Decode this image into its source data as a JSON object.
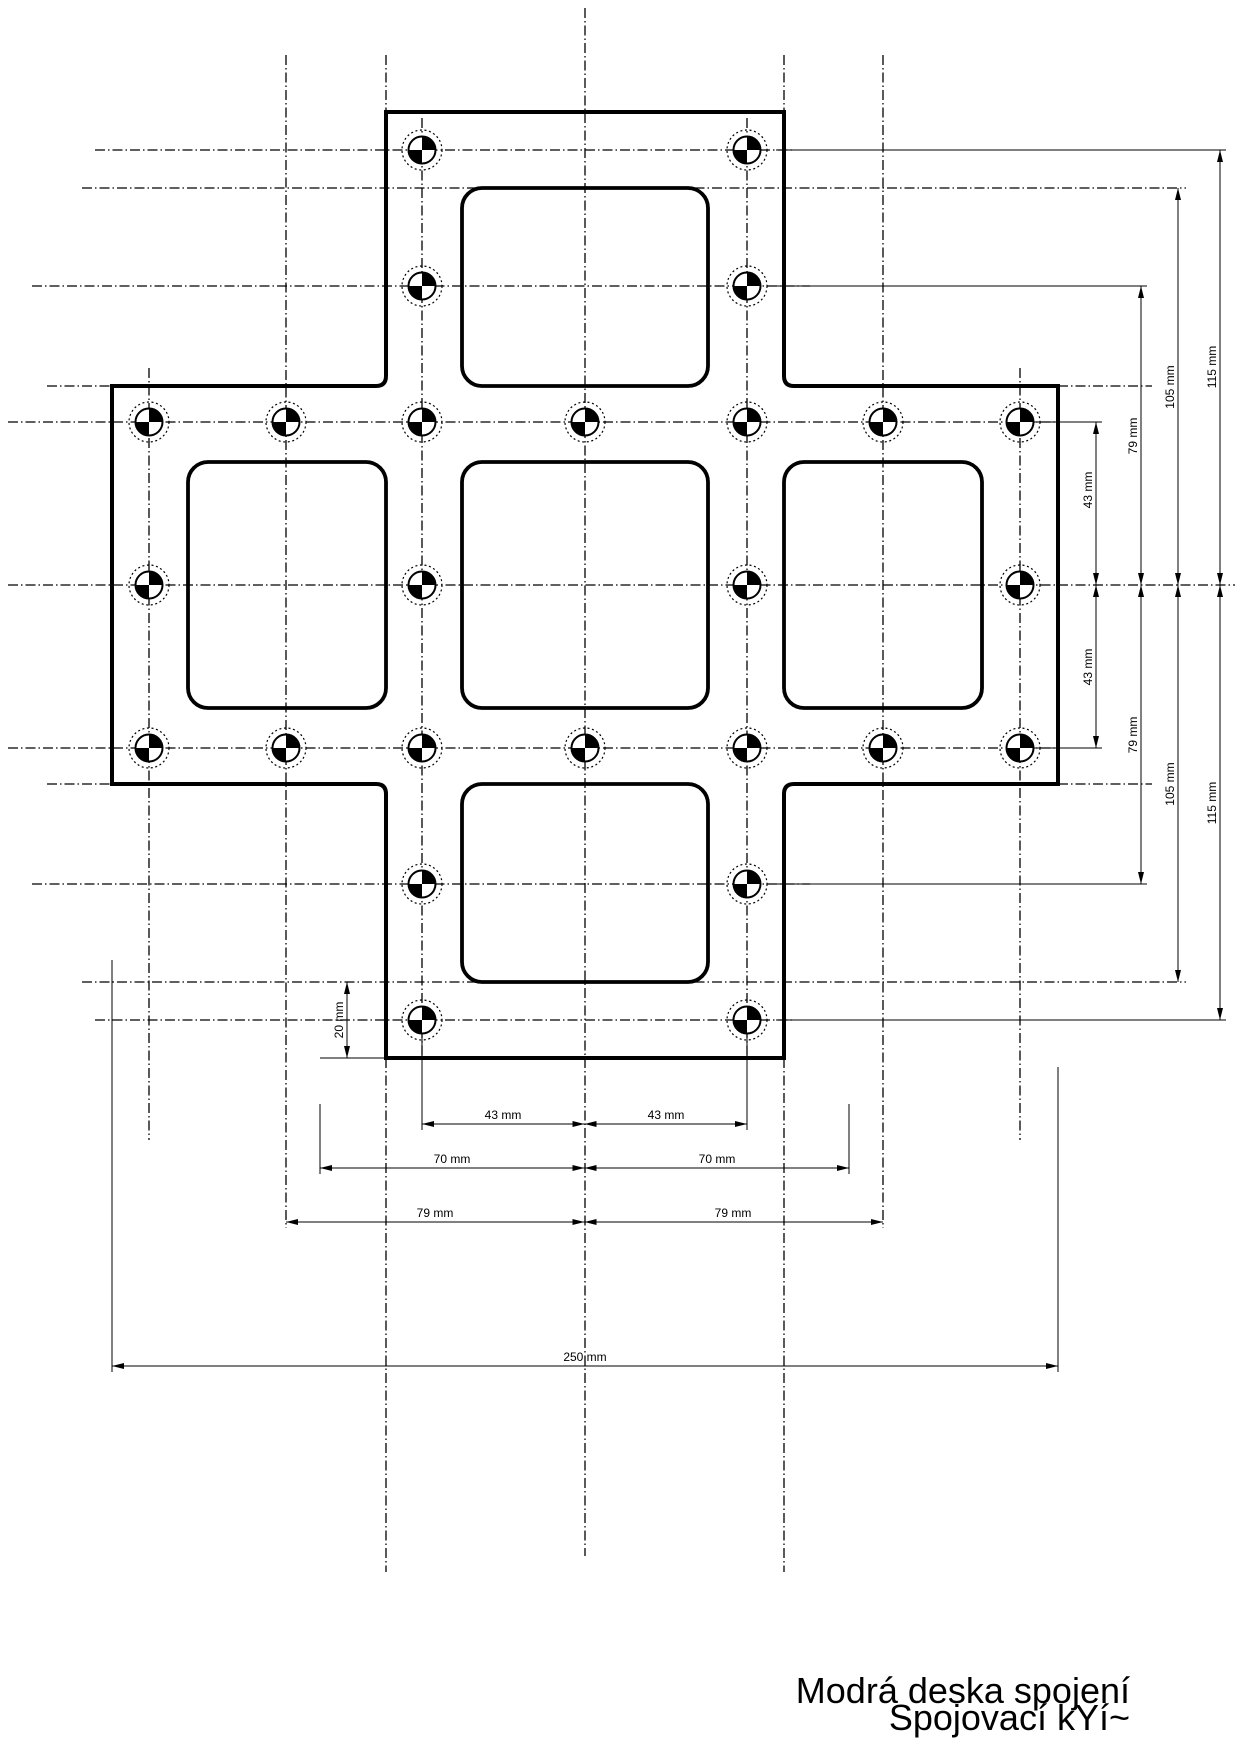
{
  "title": {
    "line1": "Modrá deska spojení",
    "line2": "Spojovací kYí~"
  },
  "labels": {
    "d20": "20 mm",
    "d43": "43 mm",
    "d70": "70 mm",
    "d79": "79 mm",
    "d105": "105 mm",
    "d115": "115 mm",
    "d250": "250 mm"
  },
  "colors": {
    "ink": "#000000",
    "paper": "#ffffff"
  }
}
